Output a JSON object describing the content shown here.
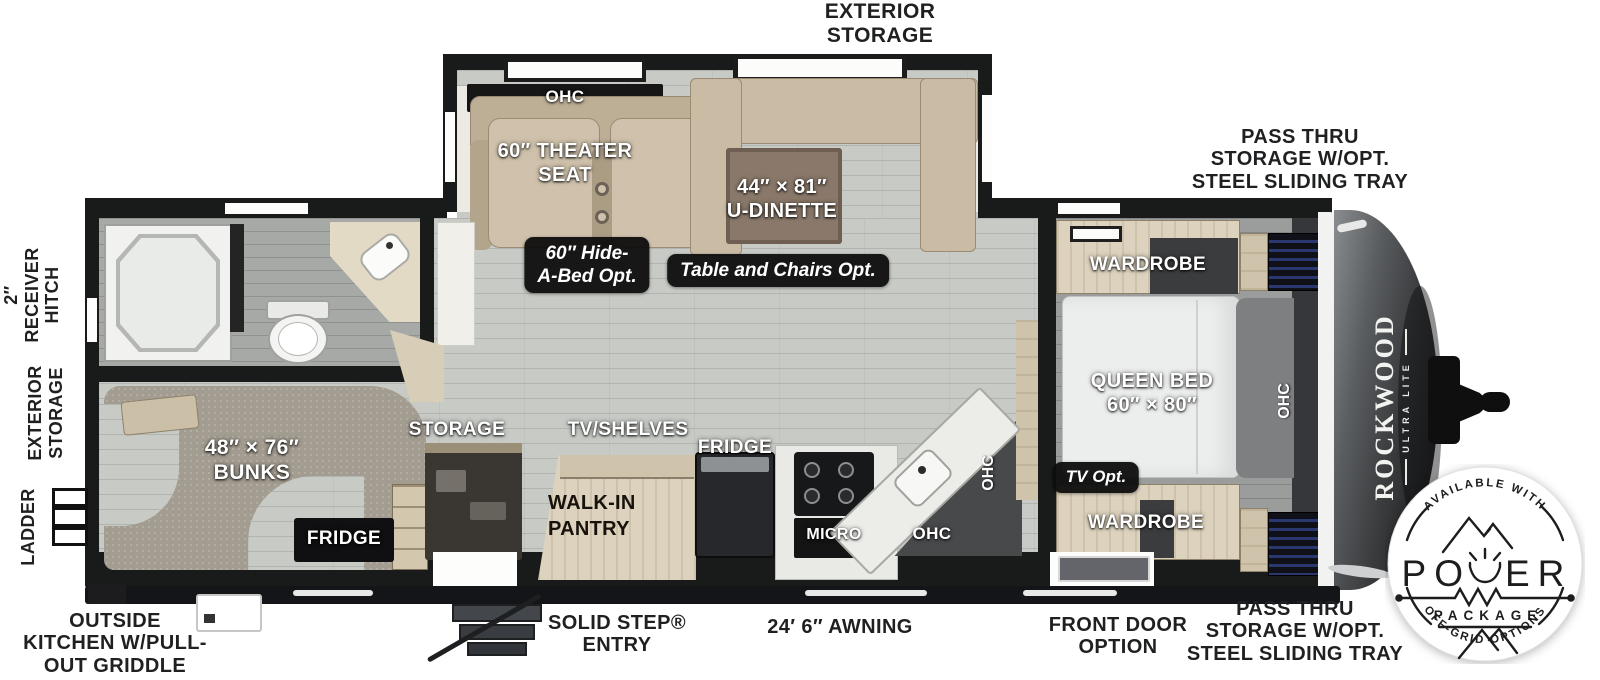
{
  "labels": {
    "exterior_storage": "EXTERIOR\nSTORAGE",
    "pass_thru": "PASS THRU\nSTORAGE W/OPT.\nSTEEL SLIDING TRAY",
    "receiver_hitch": "2″\nRECEIVER\nHITCH",
    "ladder": "LADDER",
    "outside_kitchen": "OUTSIDE\nKITCHEN W/PULL-\nOUT GRIDDLE",
    "solid_step": "SOLID STEP®\nENTRY",
    "awning": "24′ 6″ AWNING",
    "front_door": "FRONT DOOR\nOPTION",
    "ohc": "OHC",
    "theater_seat": "60″ THEATER\nSEAT",
    "u_dinette": "44″ × 81″\nU-DINETTE",
    "hide_a_bed_opt": "60″ Hide-\nA-Bed Opt.",
    "table_chairs_opt": "Table and Chairs Opt.",
    "wardrobe": "WARDROBE",
    "queen_bed": "QUEEN BED\n60″ × 80″",
    "tv_opt": "TV Opt.",
    "bunks": "48″ × 76″\nBUNKS",
    "fridge": "FRIDGE",
    "storage": "STORAGE",
    "tv_shelves": "TV/SHELVES",
    "walk_in_pantry": "WALK-IN\nPANTRY",
    "micro": "MICRO"
  },
  "brand": {
    "name": "ROCKWOOD",
    "sub": "ULTRA LITE"
  },
  "badge": {
    "arc_top": "AVAILABLE WITH",
    "power_left": "PO",
    "power_right": "ER",
    "package": "PACKAGE",
    "arc_bottom": "OFF-GRID OPTIONS"
  },
  "colors": {
    "wall": "#191a1a",
    "floor": "#c7cac5",
    "carpet": "#a39c90",
    "wood": "#dcd2bd",
    "seat_tan": "#c9bba4",
    "shelf_blue": "#2b3870",
    "badge_ink": "#1d1d1d"
  }
}
